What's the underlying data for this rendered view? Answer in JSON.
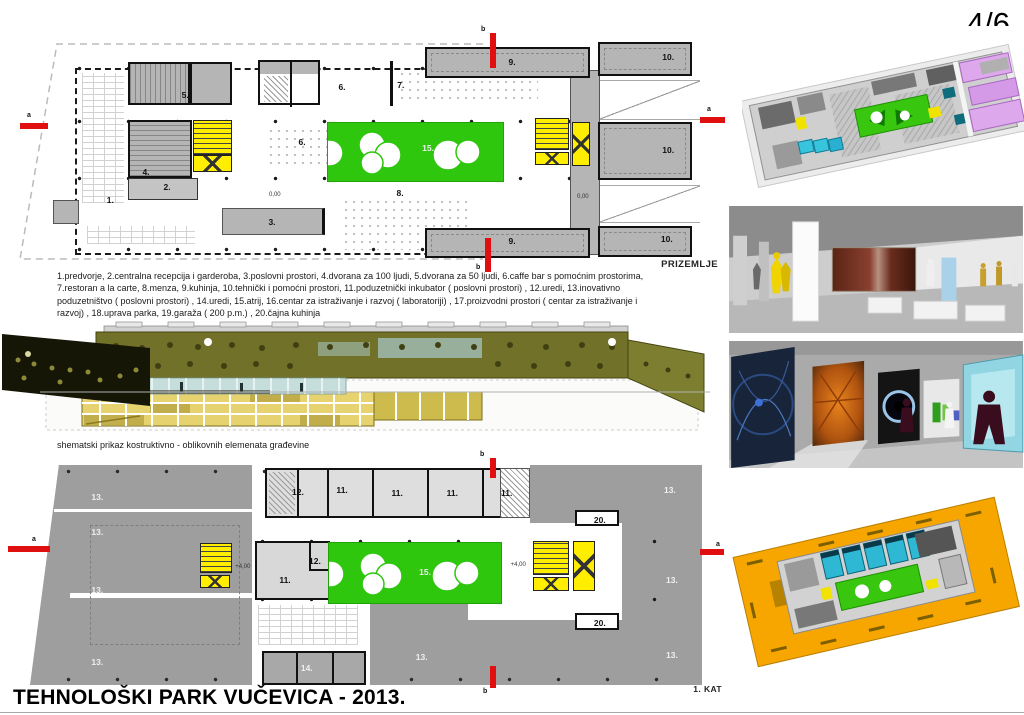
{
  "page": {
    "number": "4/6",
    "title": "TEHNOLOŠKI PARK VUČEVICA - 2013."
  },
  "legend": {
    "lines": [
      "1.predvorje, 2.centralna recepcija i garderoba, 3.poslovni prostori, 4.dvorana za 100 ljudi, 5.dvorana za 50 ljudi, 6.caffe bar s pomoćnim prostorima,",
      "7.restoran a la carte, 8.menza, 9.kuhinja, 10.tehnički i pomoćni prostori, 11.poduzetnički inkubator ( poslovni prostori) , 12.uredi, 13.inovativno",
      "poduzetništvo ( poslovni prostori) , 14.uredi, 15.atrij, 16.centar za istraživanje i razvoj ( laboratoriji) , 17.proizvodni prostori ( centar za istraživanje i",
      "razvoj) , 18.uprava parka, 19.garaža ( 200 p.m.) , 20.čajna kuhinja"
    ]
  },
  "section_drawing": {
    "caption": "shematski prikaz kostruktivno - oblikovnih elemenata građevine"
  },
  "ground_floor": {
    "name": "PRIZEMLJE",
    "markers": [
      {
        "letter": "a"
      },
      {
        "letter": "a"
      },
      {
        "letter": "b"
      },
      {
        "letter": "b"
      }
    ],
    "room_labels": [
      {
        "t": "1.",
        "x": 12.9,
        "y": 69.6
      },
      {
        "t": "2.",
        "x": 21.0,
        "y": 64.4
      },
      {
        "t": "3.",
        "x": 36.0,
        "y": 78.5
      },
      {
        "t": "4.",
        "x": 18.0,
        "y": 58.3
      },
      {
        "t": "5.",
        "x": 23.6,
        "y": 27.1
      },
      {
        "t": "6.",
        "x": 46.0,
        "y": 23.9
      },
      {
        "t": "6.",
        "x": 40.3,
        "y": 46.2
      },
      {
        "t": "7.",
        "x": 54.4,
        "y": 23.1
      },
      {
        "t": "8.",
        "x": 54.3,
        "y": 66.8
      },
      {
        "t": "9.",
        "x": 70.3,
        "y": 13.8
      },
      {
        "t": "9.",
        "x": 70.3,
        "y": 86.2
      },
      {
        "t": "10.",
        "x": 92.6,
        "y": 11.7
      },
      {
        "t": "10.",
        "x": 92.6,
        "y": 49.4
      },
      {
        "t": "10.",
        "x": 92.4,
        "y": 85.4
      },
      {
        "t": "15.",
        "x": 58.3,
        "y": 48.6,
        "cls": "light"
      },
      {
        "t": "0,00",
        "x": 36.4,
        "y": 67.6,
        "cls": "tiny"
      },
      {
        "t": "0,00",
        "x": 80.4,
        "y": 68.4,
        "cls": "tiny"
      }
    ]
  },
  "first_floor": {
    "name": "1. KAT",
    "markers": [
      {
        "letter": "a"
      },
      {
        "letter": "a"
      },
      {
        "letter": "b"
      },
      {
        "letter": "b"
      }
    ],
    "room_labels": [
      {
        "t": "13.",
        "x": 9.9,
        "y": 17.9,
        "cls": "light"
      },
      {
        "t": "13.",
        "x": 9.9,
        "y": 32.8,
        "cls": "light"
      },
      {
        "t": "13.",
        "x": 9.9,
        "y": 57.4,
        "cls": "light"
      },
      {
        "t": "13.",
        "x": 9.9,
        "y": 88.1,
        "cls": "light"
      },
      {
        "t": "13.",
        "x": 94.1,
        "y": 14.9,
        "cls": "light"
      },
      {
        "t": "13.",
        "x": 94.4,
        "y": 53.2,
        "cls": "light"
      },
      {
        "t": "13.",
        "x": 94.4,
        "y": 85.1,
        "cls": "light"
      },
      {
        "t": "13.",
        "x": 57.6,
        "y": 86.0,
        "cls": "light"
      },
      {
        "t": "14.",
        "x": 40.7,
        "y": 90.6,
        "cls": "light"
      },
      {
        "t": "12.",
        "x": 39.4,
        "y": 15.7
      },
      {
        "t": "11.",
        "x": 45.9,
        "y": 14.9
      },
      {
        "t": "11.",
        "x": 54.0,
        "y": 16.2
      },
      {
        "t": "11.",
        "x": 62.1,
        "y": 16.2
      },
      {
        "t": "11.",
        "x": 70.1,
        "y": 16.2
      },
      {
        "t": "12.",
        "x": 41.9,
        "y": 45.1
      },
      {
        "t": "11.",
        "x": 37.5,
        "y": 53.2
      },
      {
        "t": "20.",
        "x": 83.8,
        "y": 27.7
      },
      {
        "t": "20.",
        "x": 83.8,
        "y": 71.5
      },
      {
        "t": "15.",
        "x": 58.1,
        "y": 49.8,
        "cls": "light"
      },
      {
        "t": "+4,00",
        "x": 31.3,
        "y": 47.7,
        "cls": "tiny"
      },
      {
        "t": "+4,00",
        "x": 71.8,
        "y": 46.8,
        "cls": "tiny"
      }
    ]
  },
  "renders": {
    "items": [
      {
        "name": "axonometric ground floor render"
      },
      {
        "name": "interior render exhibition hall"
      },
      {
        "name": "interior render gallery corridor"
      },
      {
        "name": "axonometric first floor render"
      }
    ]
  },
  "colors": {
    "atrium_green": "#2fc60e",
    "stair_yellow": "#ffee00",
    "marker_red": "#e01010",
    "section_olive": "#71712a",
    "render_orange": "#f7a600"
  }
}
